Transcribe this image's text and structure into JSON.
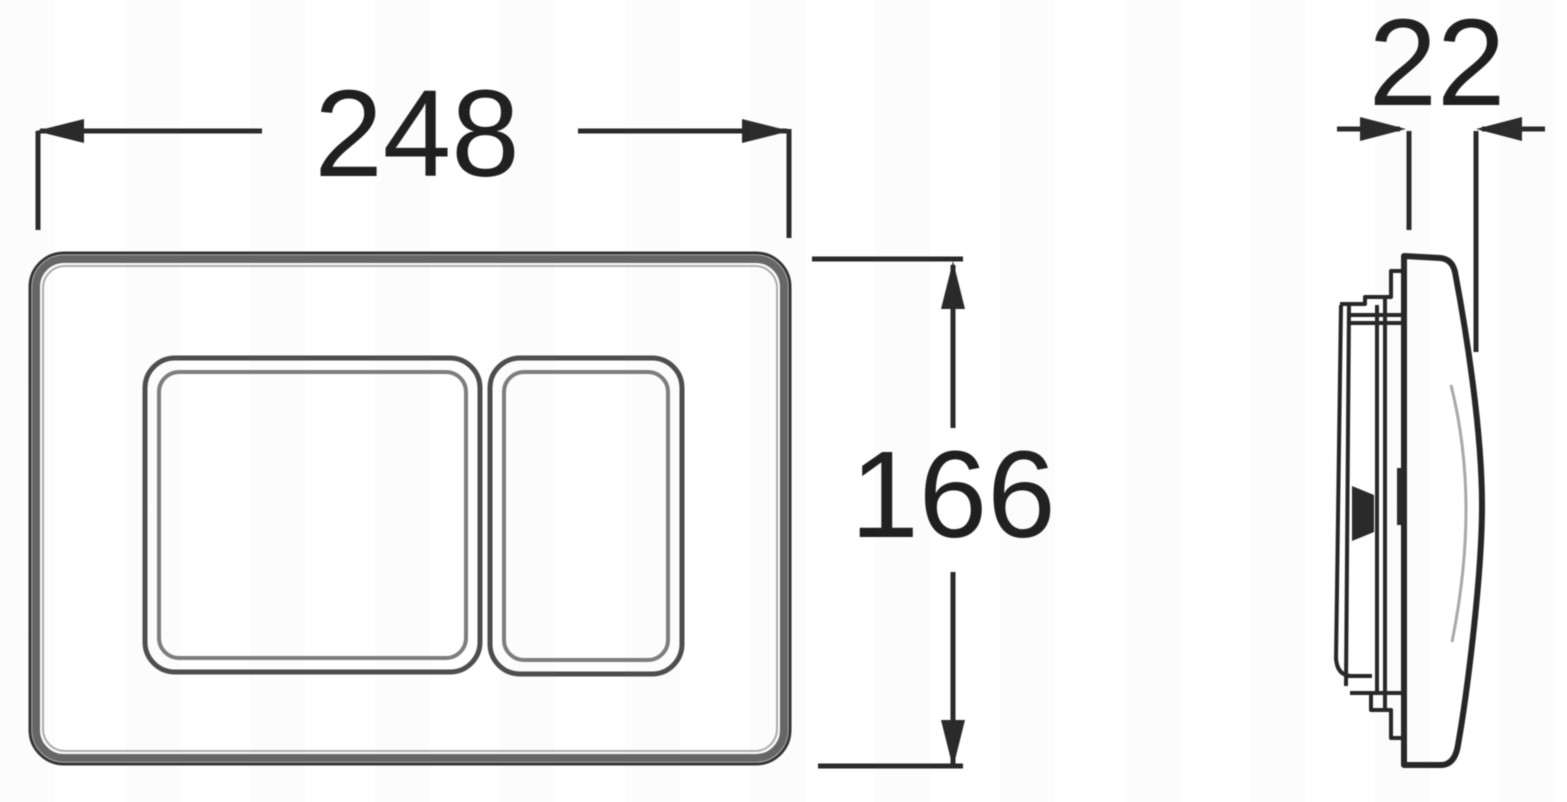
{
  "drawing": {
    "front_view": {
      "width_dim": "248",
      "height_dim": "166"
    },
    "side_view": {
      "depth_dim": "22"
    },
    "colors": {
      "line": "#2a2a2a",
      "panel_edge_dark": "#333333",
      "panel_edge_mid": "#666666",
      "panel_edge_light": "#adadad",
      "background": "#ffffff"
    }
  }
}
